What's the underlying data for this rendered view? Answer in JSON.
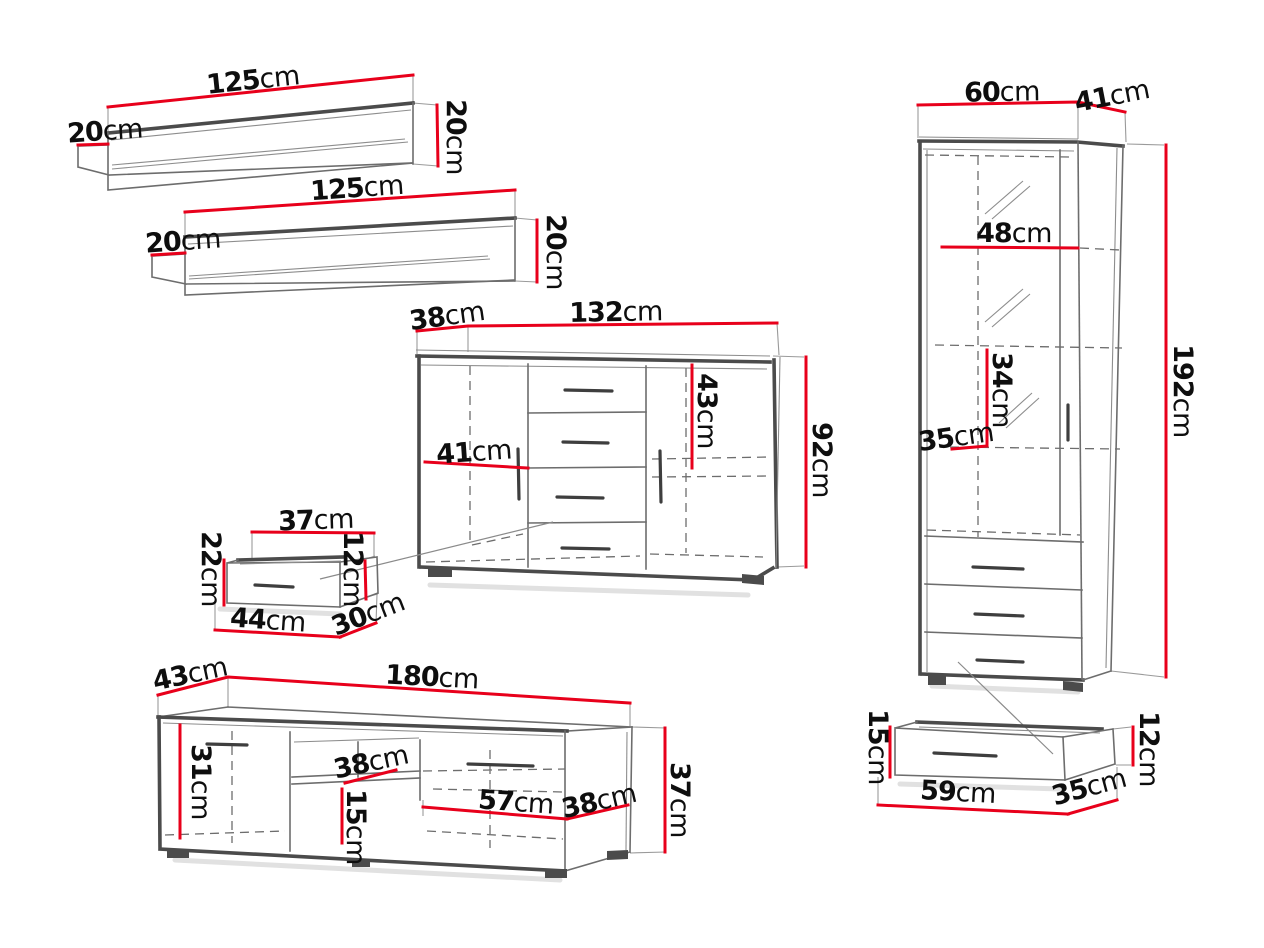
{
  "diagram": {
    "unit": "cm",
    "colors": {
      "dimension_red": "#e8001b",
      "outline_gray": "#4b4b4b",
      "text_black": "#0e0e0e",
      "background": "#ffffff"
    },
    "items": {
      "wall_shelf_top": {
        "name": "wall shelf (upper)",
        "width": {
          "v": "125",
          "u": "cm"
        },
        "depth": {
          "v": "20",
          "u": "cm"
        },
        "height": {
          "v": "20",
          "u": "cm"
        }
      },
      "wall_shelf_bottom": {
        "name": "wall shelf (lower)",
        "width": {
          "v": "125",
          "u": "cm"
        },
        "depth": {
          "v": "20",
          "u": "cm"
        },
        "height": {
          "v": "20",
          "u": "cm"
        }
      },
      "sideboard": {
        "name": "sideboard",
        "depth": {
          "v": "38",
          "u": "cm"
        },
        "width": {
          "v": "132",
          "u": "cm"
        },
        "door_inner_height": {
          "v": "43",
          "u": "cm"
        },
        "height": {
          "v": "92",
          "u": "cm"
        },
        "inner_width": {
          "v": "41",
          "u": "cm"
        }
      },
      "drawer_insert": {
        "name": "internal drawer",
        "top_width": {
          "v": "37",
          "u": "cm"
        },
        "height": {
          "v": "22",
          "u": "cm"
        },
        "front_height": {
          "v": "12",
          "u": "cm"
        },
        "bottom_width": {
          "v": "44",
          "u": "cm"
        },
        "depth": {
          "v": "30",
          "u": "cm"
        }
      },
      "tv_stand": {
        "name": "TV stand",
        "depth": {
          "v": "43",
          "u": "cm"
        },
        "width": {
          "v": "180",
          "u": "cm"
        },
        "inner_height": {
          "v": "31",
          "u": "cm"
        },
        "shelf_width": {
          "v": "38",
          "u": "cm"
        },
        "shelf_height": {
          "v": "15",
          "u": "cm"
        },
        "inner_width": {
          "v": "57",
          "u": "cm"
        },
        "inner_depth": {
          "v": "38",
          "u": "cm"
        },
        "height": {
          "v": "37",
          "u": "cm"
        }
      },
      "display_cabinet": {
        "name": "tall display cabinet",
        "width": {
          "v": "60",
          "u": "cm"
        },
        "depth": {
          "v": "41",
          "u": "cm"
        },
        "inner_width": {
          "v": "48",
          "u": "cm"
        },
        "inner_height": {
          "v": "34",
          "u": "cm"
        },
        "inner_depth": {
          "v": "35",
          "u": "cm"
        },
        "height": {
          "v": "192",
          "u": "cm"
        }
      },
      "cabinet_drawer": {
        "name": "cabinet drawer",
        "height": {
          "v": "15",
          "u": "cm"
        },
        "front_height": {
          "v": "12",
          "u": "cm"
        },
        "width": {
          "v": "59",
          "u": "cm"
        },
        "depth": {
          "v": "35",
          "u": "cm"
        }
      }
    }
  }
}
